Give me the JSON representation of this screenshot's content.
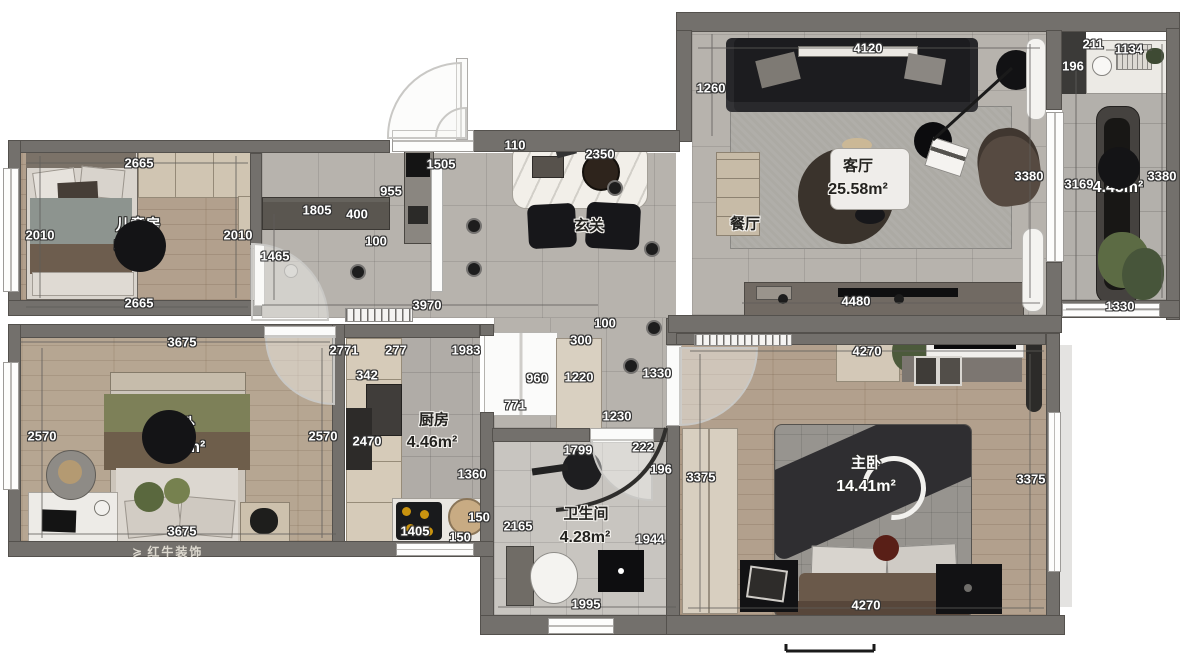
{
  "plan": {
    "type": "apartment-floor-plan",
    "watermark": "红牛装饰",
    "palette": {
      "wall": "#73706c",
      "tile_floor": "#b7b3ad",
      "wood_floor": "#b2a08d",
      "bath_floor": "#c8c5c0",
      "label_text": "#ffffff",
      "dark_label_text": "#23221f",
      "sofa": "#1c1c1f",
      "cabinet_tan": "#d2c7b5"
    },
    "rooms": [
      {
        "name": "儿童房",
        "area": "5.36m²",
        "style": "light",
        "nx": 138,
        "ny": 225,
        "ax": 139,
        "ay": 247,
        "badge": {
          "cx": 140,
          "cy": 246,
          "r": 26
        }
      },
      {
        "name": "次卧",
        "area": "9.44m²",
        "style": "light",
        "nx": 180,
        "ny": 424,
        "ax": 180,
        "ay": 448,
        "badge": {
          "cx": 169,
          "cy": 437,
          "r": 27
        }
      },
      {
        "name": "主卧",
        "area": "14.41m²",
        "style": "light",
        "nx": 866,
        "ny": 463,
        "ax": 866,
        "ay": 487
      },
      {
        "name": "阳台",
        "area": "4.45m²",
        "style": "light",
        "nx": 1120,
        "ny": 165,
        "ax": 1118,
        "ay": 188,
        "badge": {
          "cx": 1119,
          "cy": 168,
          "r": 21
        }
      },
      {
        "name": "客厅",
        "area": "25.58m²",
        "style": "dark",
        "nx": 858,
        "ny": 166,
        "ax": 858,
        "ay": 190
      },
      {
        "name": "玄关",
        "area": "",
        "style": "dark",
        "nx": 589,
        "ny": 226
      },
      {
        "name": "餐厅",
        "area": "",
        "style": "dark",
        "nx": 745,
        "ny": 224
      },
      {
        "name": "厨房",
        "area": "4.46m²",
        "style": "dark",
        "nx": 434,
        "ny": 420,
        "ax": 432,
        "ay": 443
      },
      {
        "name": "卫生间",
        "area": "4.28m²",
        "style": "dark",
        "nx": 586,
        "ny": 514,
        "ax": 585,
        "ay": 538
      }
    ],
    "dim_labels": [
      {
        "v": "4120",
        "x": 868,
        "y": 48
      },
      {
        "v": "211",
        "x": 1093,
        "y": 44
      },
      {
        "v": "1134",
        "x": 1129,
        "y": 49
      },
      {
        "v": "196",
        "x": 1073,
        "y": 66
      },
      {
        "v": "1260",
        "x": 711,
        "y": 88
      },
      {
        "v": "2665",
        "x": 139,
        "y": 163
      },
      {
        "v": "110",
        "x": 515,
        "y": 145
      },
      {
        "v": "2350",
        "x": 600,
        "y": 154
      },
      {
        "v": "1505",
        "x": 441,
        "y": 164
      },
      {
        "v": "3380",
        "x": 1029,
        "y": 176
      },
      {
        "v": "3169",
        "x": 1079,
        "y": 184
      },
      {
        "v": "3380",
        "x": 1162,
        "y": 176
      },
      {
        "v": "955",
        "x": 391,
        "y": 191
      },
      {
        "v": "1805",
        "x": 317,
        "y": 210
      },
      {
        "v": "400",
        "x": 357,
        "y": 214
      },
      {
        "v": "2010",
        "x": 40,
        "y": 235
      },
      {
        "v": "2010",
        "x": 238,
        "y": 235
      },
      {
        "v": "100",
        "x": 376,
        "y": 241
      },
      {
        "v": "1465",
        "x": 275,
        "y": 256
      },
      {
        "v": "2665",
        "x": 139,
        "y": 303
      },
      {
        "v": "3970",
        "x": 427,
        "y": 305
      },
      {
        "v": "4480",
        "x": 856,
        "y": 301
      },
      {
        "v": "1330",
        "x": 1120,
        "y": 306
      },
      {
        "v": "100",
        "x": 605,
        "y": 323
      },
      {
        "v": "300",
        "x": 581,
        "y": 340
      },
      {
        "v": "3675",
        "x": 182,
        "y": 342
      },
      {
        "v": "2771",
        "x": 344,
        "y": 350
      },
      {
        "v": "277",
        "x": 396,
        "y": 350
      },
      {
        "v": "1983",
        "x": 466,
        "y": 350
      },
      {
        "v": "4270",
        "x": 867,
        "y": 351
      },
      {
        "v": "342",
        "x": 367,
        "y": 375
      },
      {
        "v": "960",
        "x": 537,
        "y": 378
      },
      {
        "v": "1220",
        "x": 579,
        "y": 377
      },
      {
        "v": "1330",
        "x": 657,
        "y": 373
      },
      {
        "v": "771",
        "x": 515,
        "y": 405
      },
      {
        "v": "1230",
        "x": 617,
        "y": 416
      },
      {
        "v": "2570",
        "x": 42,
        "y": 436
      },
      {
        "v": "2570",
        "x": 323,
        "y": 436
      },
      {
        "v": "2470",
        "x": 367,
        "y": 441
      },
      {
        "v": "222",
        "x": 643,
        "y": 447
      },
      {
        "v": "1799",
        "x": 578,
        "y": 450
      },
      {
        "v": "196",
        "x": 661,
        "y": 469
      },
      {
        "v": "1360",
        "x": 472,
        "y": 474
      },
      {
        "v": "3375",
        "x": 701,
        "y": 477
      },
      {
        "v": "3375",
        "x": 1031,
        "y": 479
      },
      {
        "v": "150",
        "x": 479,
        "y": 517
      },
      {
        "v": "2165",
        "x": 518,
        "y": 526
      },
      {
        "v": "1405",
        "x": 415,
        "y": 531
      },
      {
        "v": "3675",
        "x": 182,
        "y": 531
      },
      {
        "v": "150",
        "x": 460,
        "y": 537
      },
      {
        "v": "1944",
        "x": 650,
        "y": 539
      },
      {
        "v": "1995",
        "x": 586,
        "y": 604
      },
      {
        "v": "4270",
        "x": 866,
        "y": 605
      }
    ]
  }
}
